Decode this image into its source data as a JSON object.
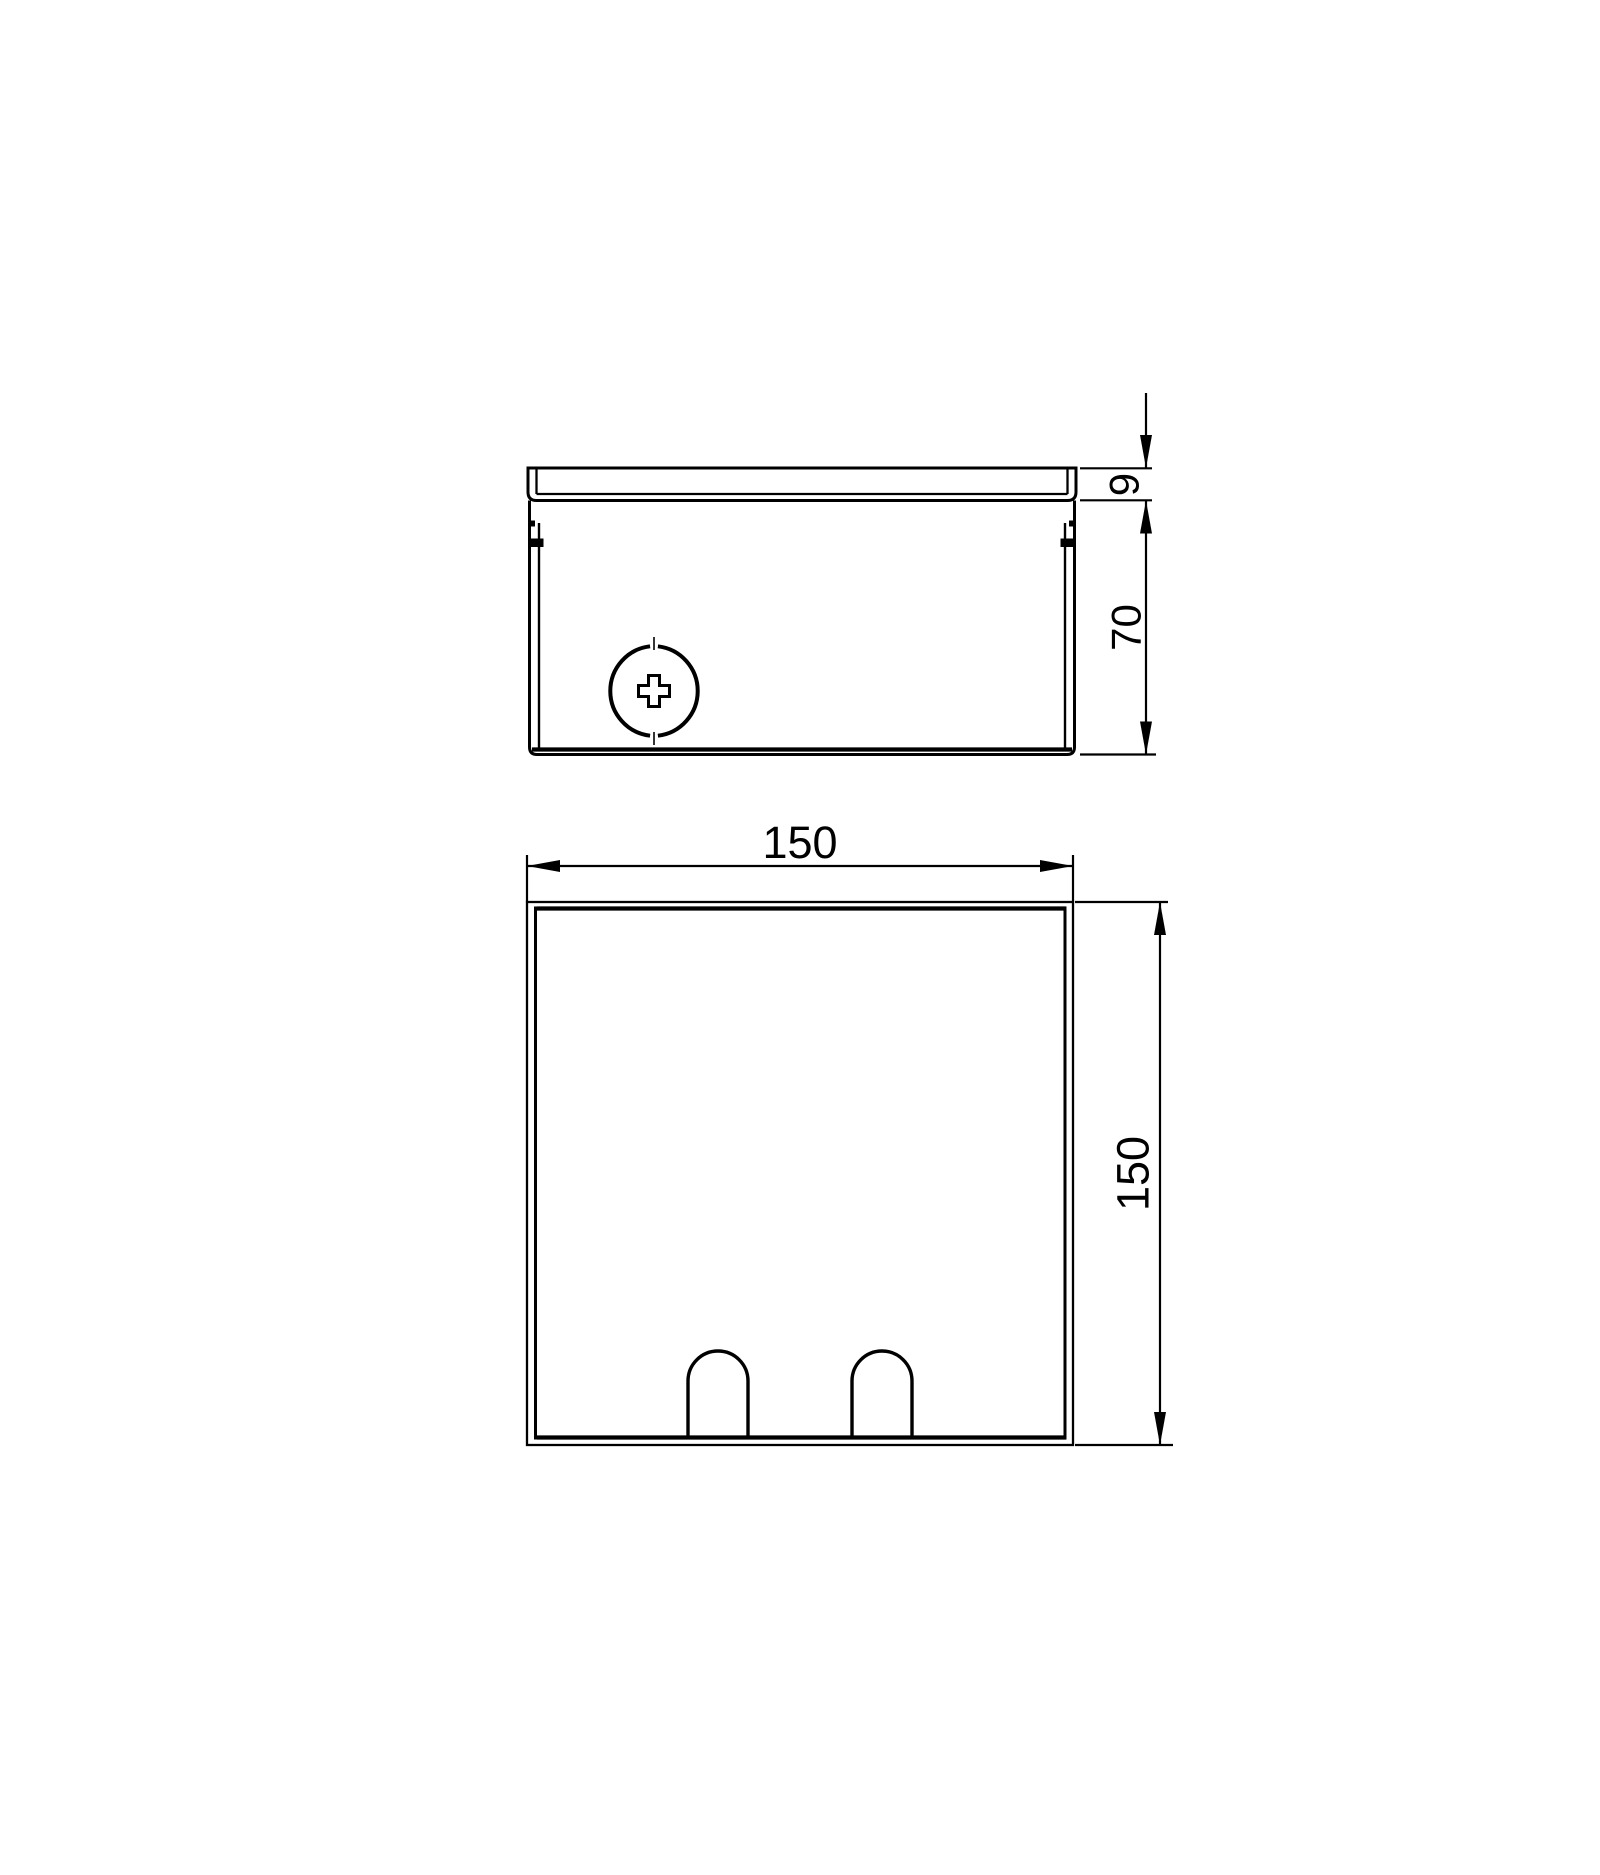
{
  "drawing": {
    "background_color": "#ffffff",
    "line_color": "#000000",
    "front_view": {
      "dim_lid_thickness": "9",
      "dim_body_height": "70"
    },
    "plan_view": {
      "dim_width": "150",
      "dim_depth": "150"
    }
  }
}
